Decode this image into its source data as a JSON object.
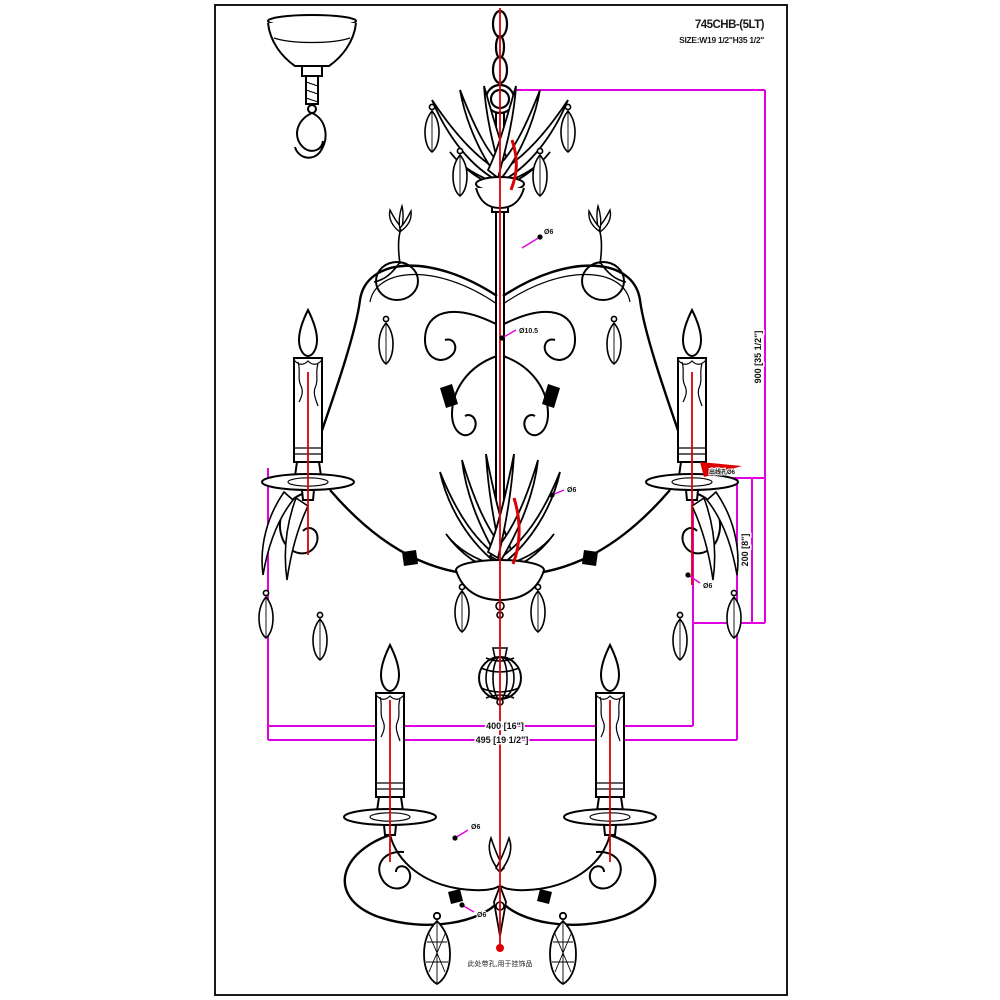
{
  "drawing": {
    "model_number": "745CHB-(5LT)",
    "size_label": "SIZE:W19 1/2\"H35 1/2\"",
    "note_bottom": "此处带孔,用于挂饰品",
    "dimensions": {
      "overall_height": "900 [35 1/2\"]",
      "lower_section_height": "200 [8\"]",
      "arm_spread_inner": "400 [16\"]",
      "arm_spread_outer": "495 [19 1/2\"]"
    },
    "annotations": {
      "a1": "Ø6",
      "a2": "Ø10.5",
      "a3": "Ø6",
      "a4": "Ø6",
      "a5": "Ø6",
      "a6": "Ø6",
      "a7": "出线孔Ø6"
    },
    "colors": {
      "line": "#000000",
      "dimension": "#e100e1",
      "wire": "#dd0000",
      "background": "#ffffff"
    }
  }
}
